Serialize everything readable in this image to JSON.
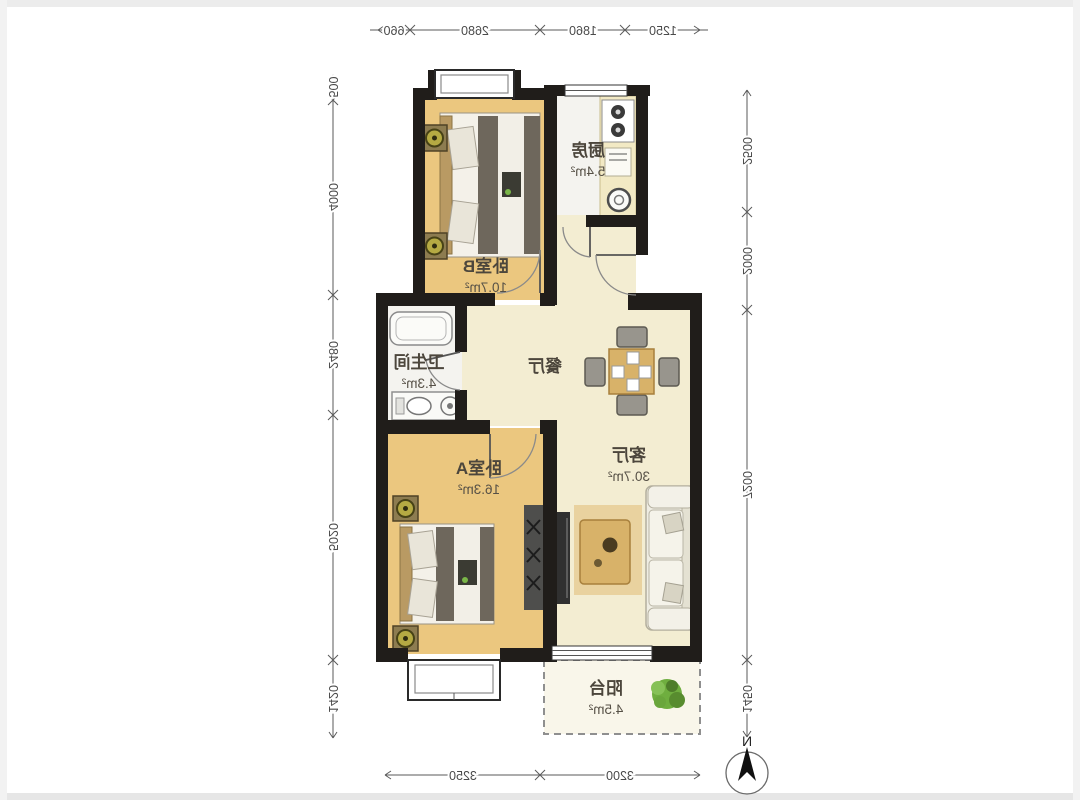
{
  "rooms": {
    "kitchen": {
      "name": "厨房",
      "area": "5.4m²"
    },
    "bedroom_b": {
      "name": "卧室B",
      "area": "10.7m²"
    },
    "bathroom": {
      "name": "卫生间",
      "area": "4.3m²"
    },
    "dining": {
      "name": "餐厅"
    },
    "living": {
      "name": "客厅",
      "area": "30.7m²"
    },
    "bedroom_a": {
      "name": "卧室A",
      "area": "16.3m²"
    },
    "balcony": {
      "name": "阳台",
      "area": "4.5m²"
    }
  },
  "dims": {
    "top": [
      "1250",
      "1860",
      "2680",
      "660"
    ],
    "bottom": [
      "3200",
      "3250"
    ],
    "left": [
      "2500",
      "2000",
      "7200",
      "1450"
    ],
    "right": [
      "500",
      "4000",
      "2480",
      "5020",
      "1420"
    ]
  },
  "compass": {
    "label": "N"
  },
  "colors": {
    "wall": "#201d1a",
    "bedroom_floor": "#ebc77f",
    "living_floor": "#f3edd2",
    "wet_floor": "#f4f3ef",
    "wood_accent": "#d8b269",
    "blanket": "#6e675c",
    "plant": "#6fae3f"
  }
}
